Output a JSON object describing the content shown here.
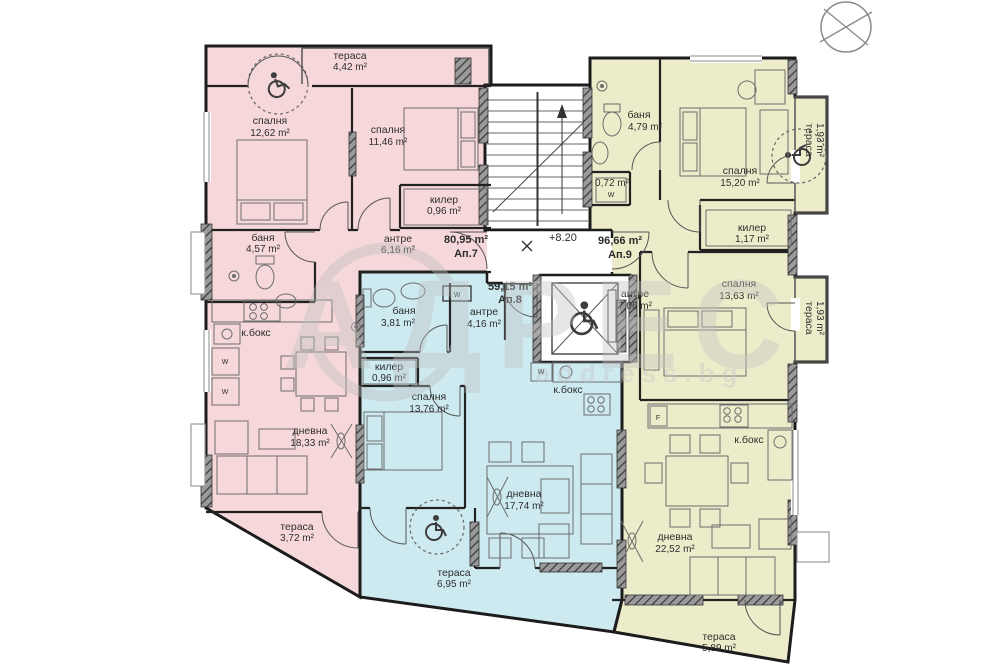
{
  "watermark": {
    "brand": "АДРЕС",
    "site": "address.bg"
  },
  "level_mark": "+8.20",
  "appliances": {
    "washer": "W",
    "fridge": "F"
  },
  "apartments": [
    {
      "label": "Ап.7",
      "area": "80,95 m²",
      "rooms": [
        {
          "name": "тераса",
          "area": "4,42 m²"
        },
        {
          "name": "спалня",
          "area": "12,62 m²"
        },
        {
          "name": "спалня",
          "area": "11,46 m²"
        },
        {
          "name": "килер",
          "area": "0,96 m²"
        },
        {
          "name": "баня",
          "area": "4,57 m²"
        },
        {
          "name": "антре",
          "area": "6,16 m²"
        },
        {
          "name": "к.бокс",
          "area": ""
        },
        {
          "name": "дневна",
          "area": "18,33 m²"
        },
        {
          "name": "тераса",
          "area": "3,72 m²"
        }
      ]
    },
    {
      "label": "Ап.8",
      "area": "59,15 m²",
      "rooms": [
        {
          "name": "баня",
          "area": "3,81 m²"
        },
        {
          "name": "антре",
          "area": "4,16 m²"
        },
        {
          "name": "килер",
          "area": "0,96 m²"
        },
        {
          "name": "спалня",
          "area": "13,76 m²"
        },
        {
          "name": "к.бокс",
          "area": ""
        },
        {
          "name": "дневна",
          "area": "17,74 m²"
        },
        {
          "name": "тераса",
          "area": "6,95 m²"
        }
      ]
    },
    {
      "label": "Ап.9",
      "area": "96,66 m²",
      "rooms": [
        {
          "name": "баня",
          "area": "4,79 m²"
        },
        {
          "name": "0,72 m²",
          "area": "W"
        },
        {
          "name": "спалня",
          "area": "15,20 m²"
        },
        {
          "name": "тераса",
          "area": "1,93 m²"
        },
        {
          "name": "килер",
          "area": "1,17 m²"
        },
        {
          "name": "антре",
          "area": "7,06 m²"
        },
        {
          "name": "спалня",
          "area": "13,63 m²"
        },
        {
          "name": "тераса",
          "area": "1,93 m²"
        },
        {
          "name": "к.бокс",
          "area": ""
        },
        {
          "name": "дневна",
          "area": "22,52 m²"
        },
        {
          "name": "тераса",
          "area": "5,89 m²"
        }
      ]
    }
  ]
}
